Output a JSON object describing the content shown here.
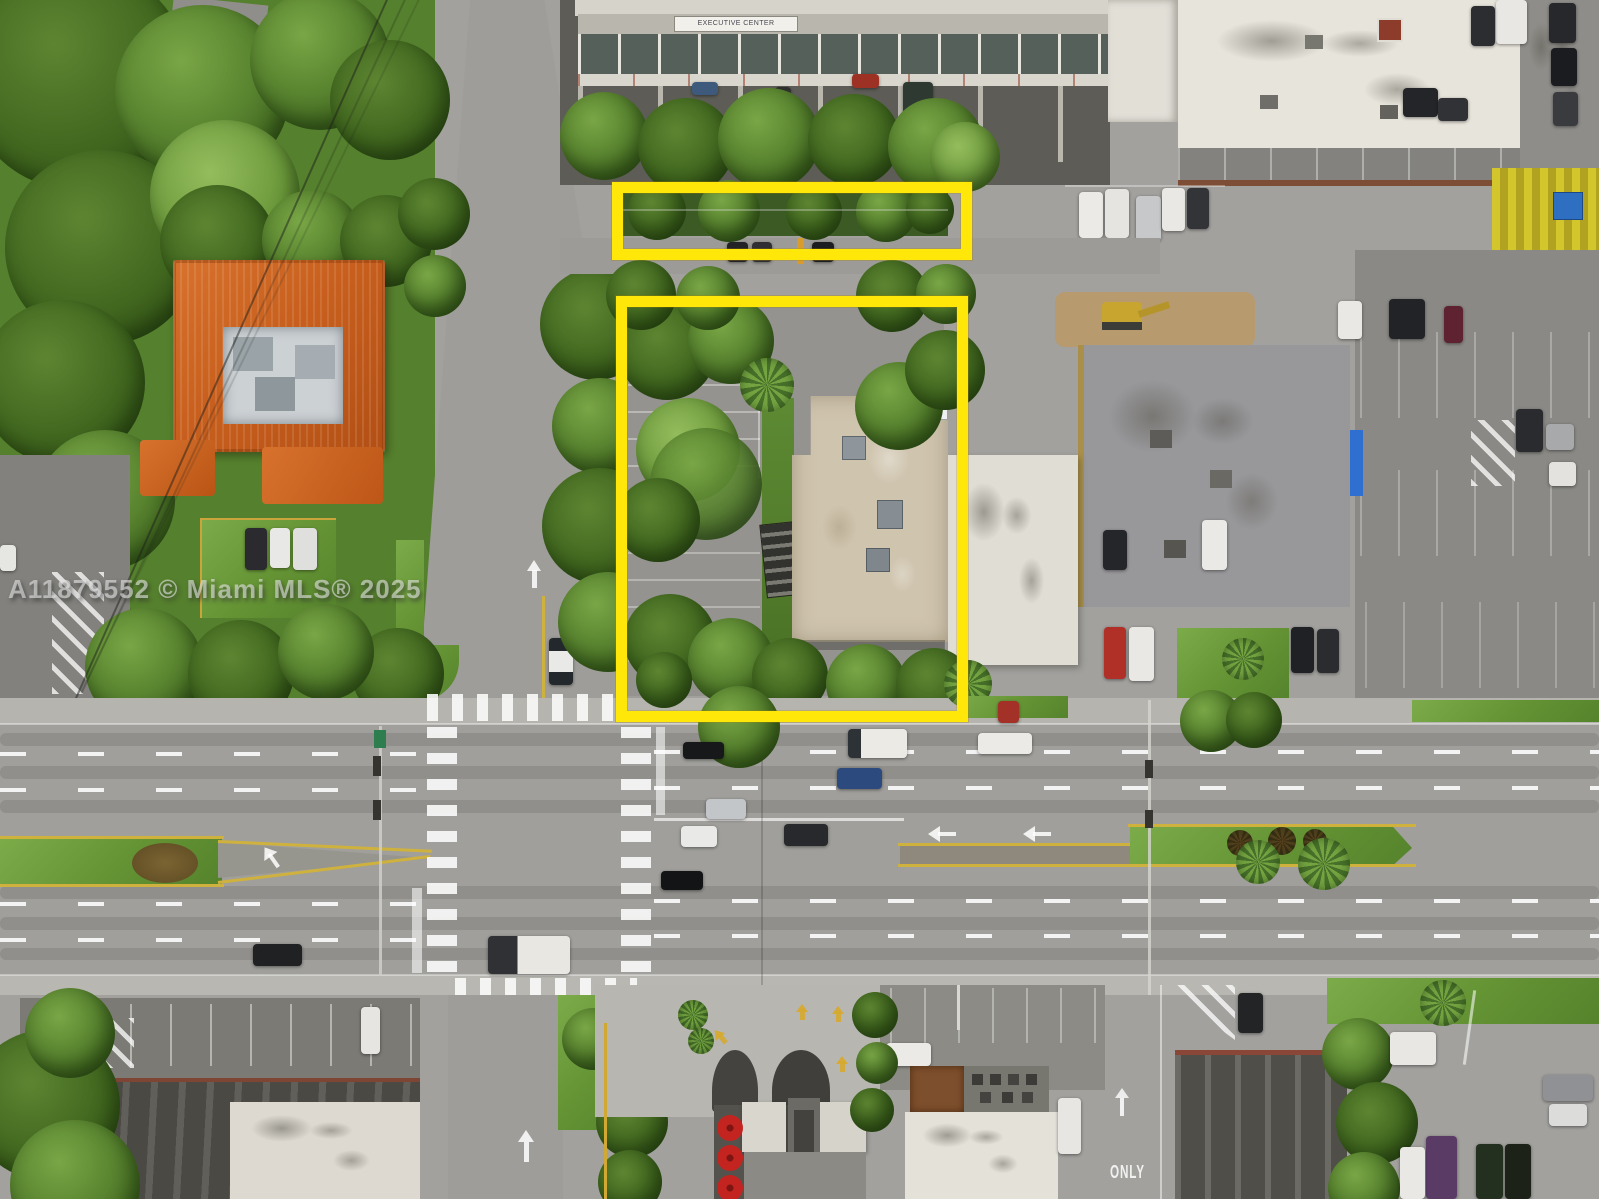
{
  "title": "Aerial drone photo of commercial corner property with highlighted parcels",
  "watermark": {
    "text": "A11879552 © Miami MLS® 2025"
  },
  "signs": {
    "building_banner": "EXECUTIVE CENTER",
    "road_marking": "ONLY"
  },
  "colors": {
    "parcel_highlight": "#FFE70A",
    "terracotta_roof": "#C85F1E",
    "grass": "#6F9C3D",
    "asphalt": "#A2A19E"
  }
}
